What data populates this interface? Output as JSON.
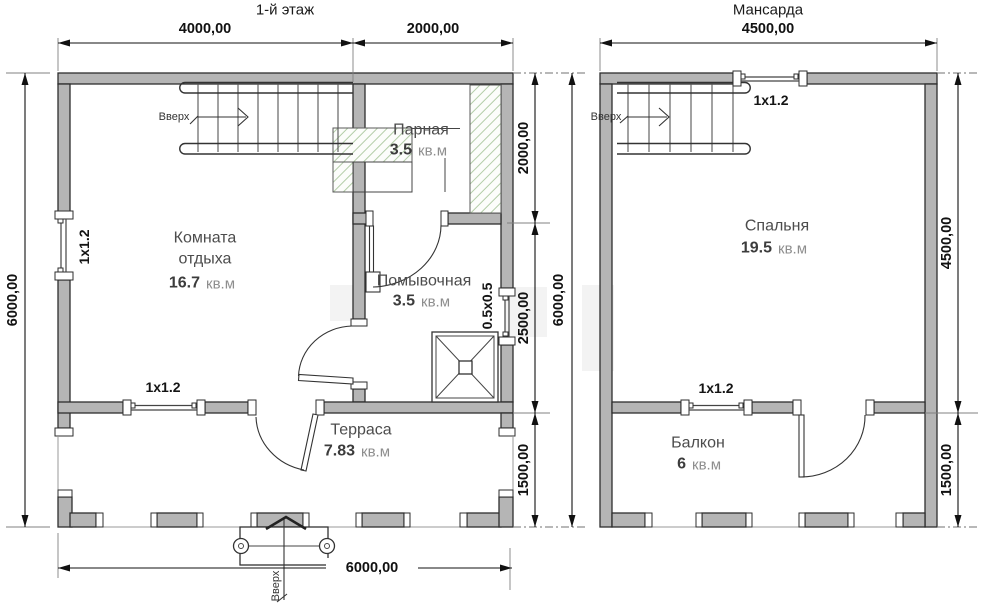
{
  "colors": {
    "wall_fill": "#b5b5b5",
    "wall_stroke": "#2e2e2e",
    "hatch_line": "#b3cda8",
    "dim_text": "#111111",
    "room_text": "#4c4c4c",
    "unit_text": "#8e8e8e"
  },
  "plans": {
    "floor1": {
      "title": "1-й этаж",
      "stairs_label": "Вверх",
      "entrance_label": "Вверх",
      "rooms": {
        "rest": {
          "name_line1": "Комната",
          "name_line2": "отдыха",
          "area_value": "16.7",
          "area_unit": "кв.м"
        },
        "sauna": {
          "name": "Парная",
          "area_value": "3.5",
          "area_unit": "кв.м"
        },
        "wash": {
          "name": "Помывочная",
          "area_value": "3.5",
          "area_unit": "кв.м"
        },
        "terrace": {
          "name": "Терраса",
          "area_value": "7.83",
          "area_unit": "кв.м"
        }
      },
      "windows": {
        "left": "1x1.2",
        "bottom": "1x1.2",
        "right": "0.5x0.5"
      },
      "dims": {
        "top_left": "4000,00",
        "top_right": "2000,00",
        "side_total": "6000,00",
        "chain_top": "2000,00",
        "chain_mid": "2500,00",
        "chain_bottom": "1500,00",
        "chain_total": "6000,00",
        "bottom_total": "6000,00"
      }
    },
    "mansard": {
      "title": "Мансарда",
      "stairs_label": "Вверх",
      "rooms": {
        "bedroom": {
          "name": "Спальня",
          "area_value": "19.5",
          "area_unit": "кв.м"
        },
        "balcony": {
          "name": "Балкон",
          "area_value": "6",
          "area_unit": "кв.м"
        }
      },
      "windows": {
        "top": "1x1.2",
        "mid": "1x1.2"
      },
      "dims": {
        "top": "4500,00",
        "side_upper": "4500,00",
        "side_lower": "1500,00"
      }
    }
  }
}
